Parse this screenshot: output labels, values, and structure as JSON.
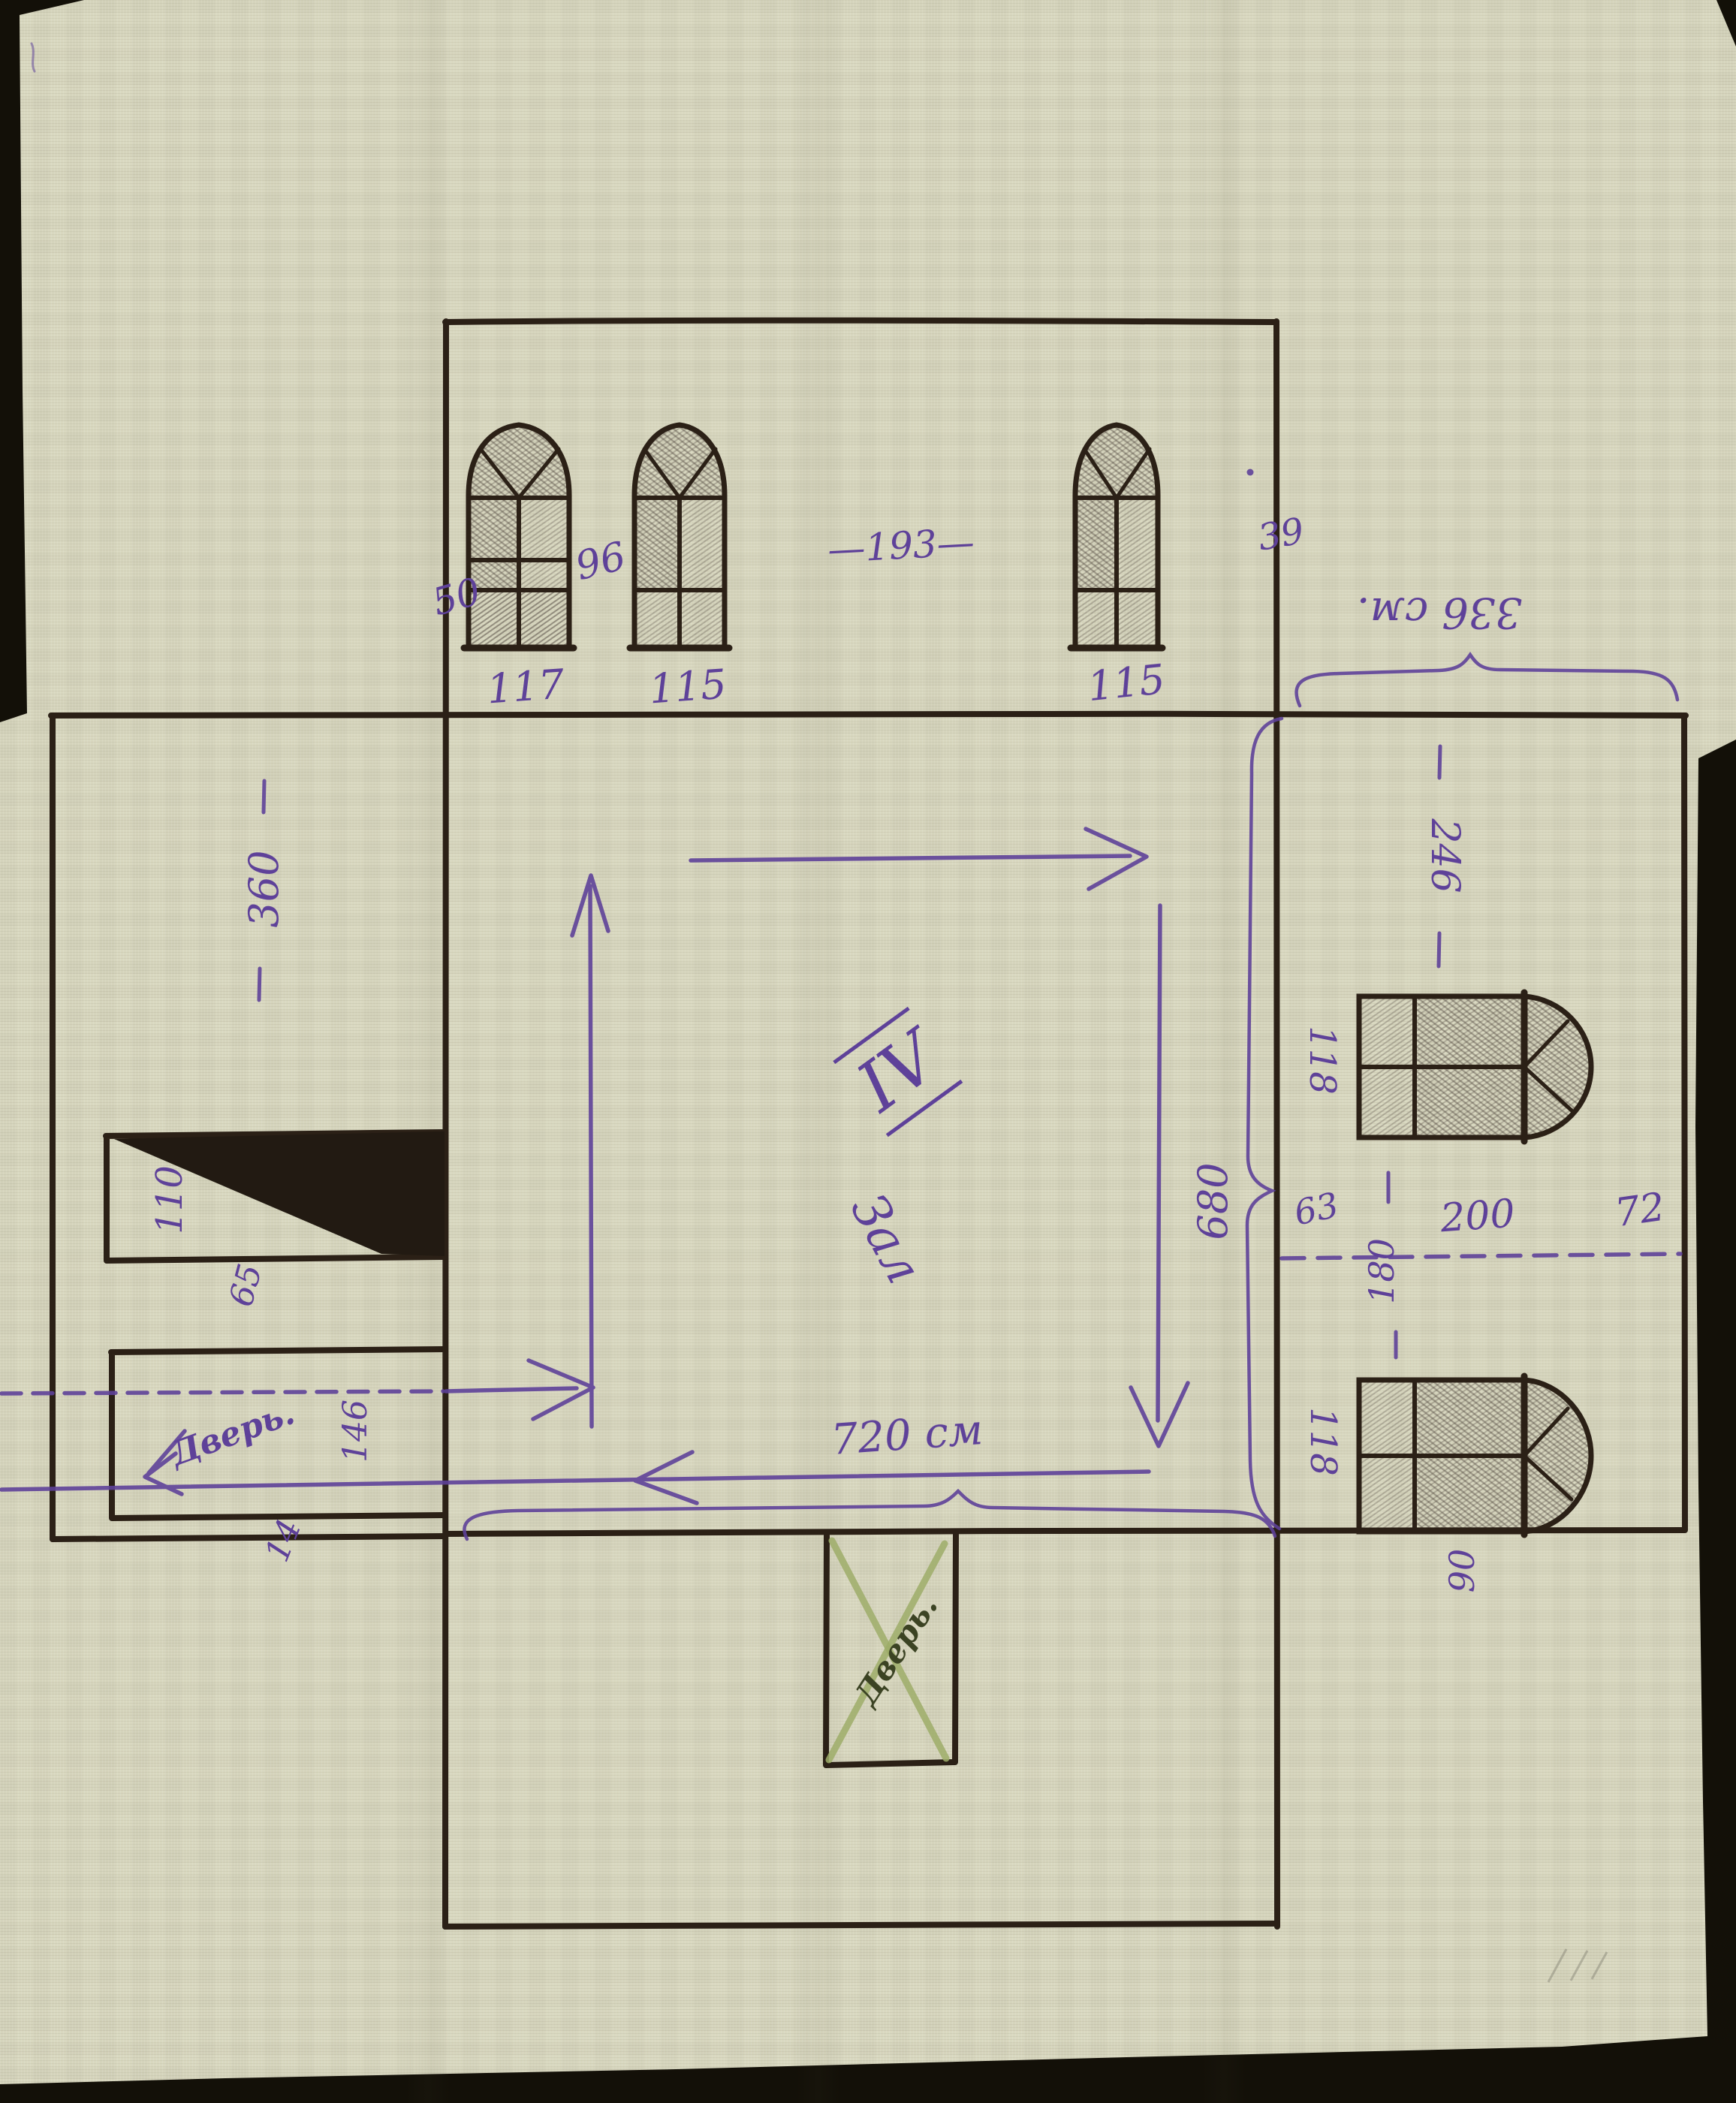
{
  "drawing": {
    "hall_numeral": "IV",
    "hall_name": "Зал",
    "doors": {
      "left_door": "Дверь.",
      "bottom_door": "Дверь."
    },
    "dimensions_cm": {
      "top_wall": {
        "left_offset": "50",
        "window1": "117",
        "gap1": "96",
        "window2": "115",
        "between": "—193—",
        "window3": "115",
        "right_offset": "39"
      },
      "right_wing_width": "336 см.",
      "right_wall": {
        "upper_segment": "246",
        "upper_window": "118",
        "offset": "63",
        "mid_segment": "180",
        "mid_segment2": "200",
        "mid_offset": "72",
        "lower_window": "118",
        "below_lower_window": "90"
      },
      "left_wall": {
        "annex_depth": "360",
        "stairs": "110",
        "gap": "65",
        "door_width": "146",
        "jamb": "14"
      },
      "room_width": "720 см",
      "room_height": "680"
    },
    "colors": {
      "cloth": "#d9d8c0",
      "ink_black": "#2b2016",
      "ink_purple": "#5e4199",
      "pencil_hatch": "#4b423a",
      "green_cross": "#a3b173",
      "green_text": "#3b4323",
      "backdrop": "#131008"
    }
  }
}
